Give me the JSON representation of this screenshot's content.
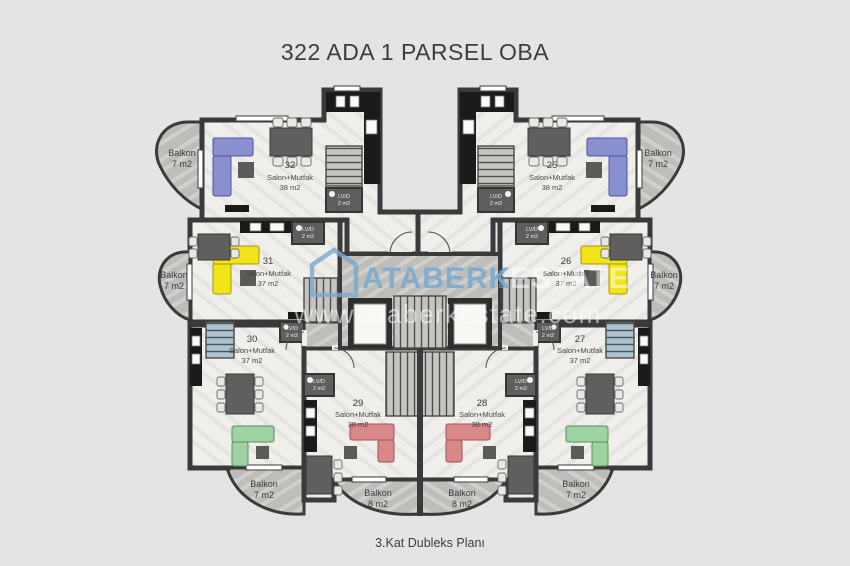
{
  "page": {
    "title": "322 ADA 1 PARSEL OBA",
    "caption": "3.Kat Dubleks Planı"
  },
  "watermark": {
    "brand": "ATABERK",
    "brand_secondary": "ESTATE",
    "vertical_text": "REAL",
    "url": "www.ataberkestate.com",
    "accent_color": "#79a8cd"
  },
  "plan": {
    "units": [
      {
        "number": "32",
        "type": "Salon+Mutfak",
        "area": "38 m2",
        "position": "top-left",
        "sofa_color": "#8a8fd0"
      },
      {
        "number": "25",
        "type": "Salon+Mutfak",
        "area": "38 m2",
        "position": "top-right",
        "sofa_color": "#8a8fd0"
      },
      {
        "number": "31",
        "type": "Salon+Mutfak",
        "area": "37 m2",
        "position": "mid-left",
        "sofa_color": "#f2e418"
      },
      {
        "number": "26",
        "type": "Salon+Mutfak",
        "area": "37 m2",
        "position": "mid-right",
        "sofa_color": "#f2e418"
      },
      {
        "number": "30",
        "type": "Salon+Mutfak",
        "area": "37 m2",
        "position": "lower-left",
        "sofa_color": "#9ed2a3"
      },
      {
        "number": "27",
        "type": "Salon+Mutfak",
        "area": "37 m2",
        "position": "lower-right",
        "sofa_color": "#9ed2a3"
      },
      {
        "number": "29",
        "type": "Salon+Mutfak",
        "area": "38 m2",
        "position": "bottom-center-left",
        "sofa_color": "#d88888"
      },
      {
        "number": "28",
        "type": "Salon+Mutfak",
        "area": "38 m2",
        "position": "bottom-center-right",
        "sofa_color": "#d88888"
      }
    ],
    "balconies": [
      {
        "label": "Balkon",
        "area": "7 m2",
        "position": "top-left"
      },
      {
        "label": "Balkon",
        "area": "7 m2",
        "position": "top-right"
      },
      {
        "label": "Balkon",
        "area": "7 m2",
        "position": "mid-left"
      },
      {
        "label": "Balkon",
        "area": "7 m2",
        "position": "mid-right"
      },
      {
        "label": "Balkon",
        "area": "7 m2",
        "position": "bottom-left"
      },
      {
        "label": "Balkon",
        "area": "7 m2",
        "position": "bottom-right"
      },
      {
        "label": "Balkon",
        "area": "8 m2",
        "position": "bottom-center-left"
      },
      {
        "label": "Balkon",
        "area": "8 m2",
        "position": "bottom-center-right"
      }
    ],
    "wet_rooms": [
      {
        "label": "LV/D",
        "area": "2 m2",
        "unit": "32"
      },
      {
        "label": "LV/D",
        "area": "2 m2",
        "unit": "25"
      },
      {
        "label": "LV/D",
        "area": "2 m2",
        "unit": "31"
      },
      {
        "label": "LV/D",
        "area": "2 m2",
        "unit": "26"
      },
      {
        "label": "LV/D",
        "area": "2 m2",
        "unit": "30"
      },
      {
        "label": "LV/D",
        "area": "2 m2",
        "unit": "27"
      },
      {
        "label": "LV/D",
        "area": "2 m2",
        "unit": "29"
      },
      {
        "label": "LV/D",
        "area": "2 m2",
        "unit": "28"
      }
    ],
    "colors": {
      "background": "#e4e4e2",
      "wall": "#3a3a3a",
      "unit_floor": "#f0efec",
      "balcony_floor": "#bebdba",
      "sofa_blue": "#8a8fd0",
      "sofa_yellow": "#f2e418",
      "sofa_green": "#9ed2a3",
      "sofa_red": "#d88888"
    }
  }
}
